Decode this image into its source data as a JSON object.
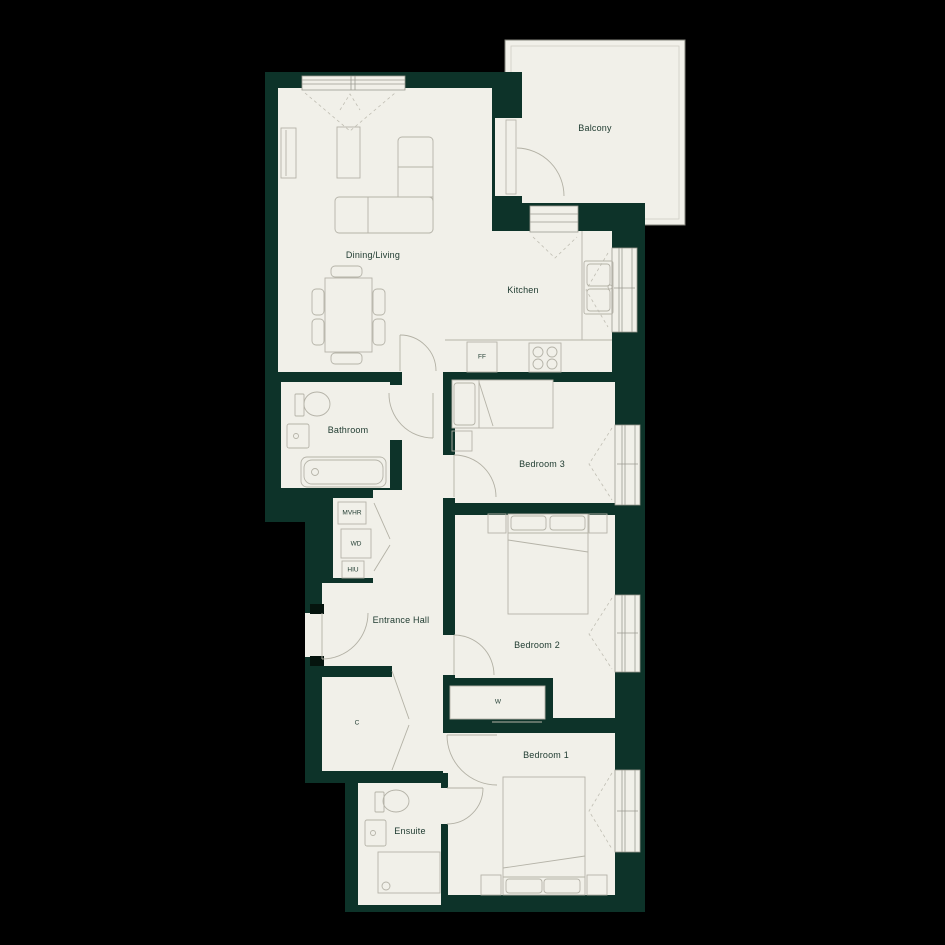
{
  "plan": {
    "type": "apartment-floorplan",
    "rooms": {
      "balcony": "Balcony",
      "dining_living": "Dining/Living",
      "kitchen": "Kitchen",
      "bathroom": "Bathroom",
      "bedroom3": "Bedroom 3",
      "entrance_hall": "Entrance Hall",
      "bedroom2": "Bedroom 2",
      "bedroom1": "Bedroom 1",
      "ensuite": "Ensuite"
    },
    "fixtures": {
      "mvhr": "MVHR",
      "wd": "WD",
      "hiu": "HIU",
      "ff": "FF",
      "wardrobe": "W",
      "cupboard": "C"
    },
    "colors": {
      "background": "#000000",
      "wall": "#0d3329",
      "floor": "#f1f0e9",
      "furniture_line": "#b5b3a8",
      "label_text": "#1d392e"
    }
  }
}
